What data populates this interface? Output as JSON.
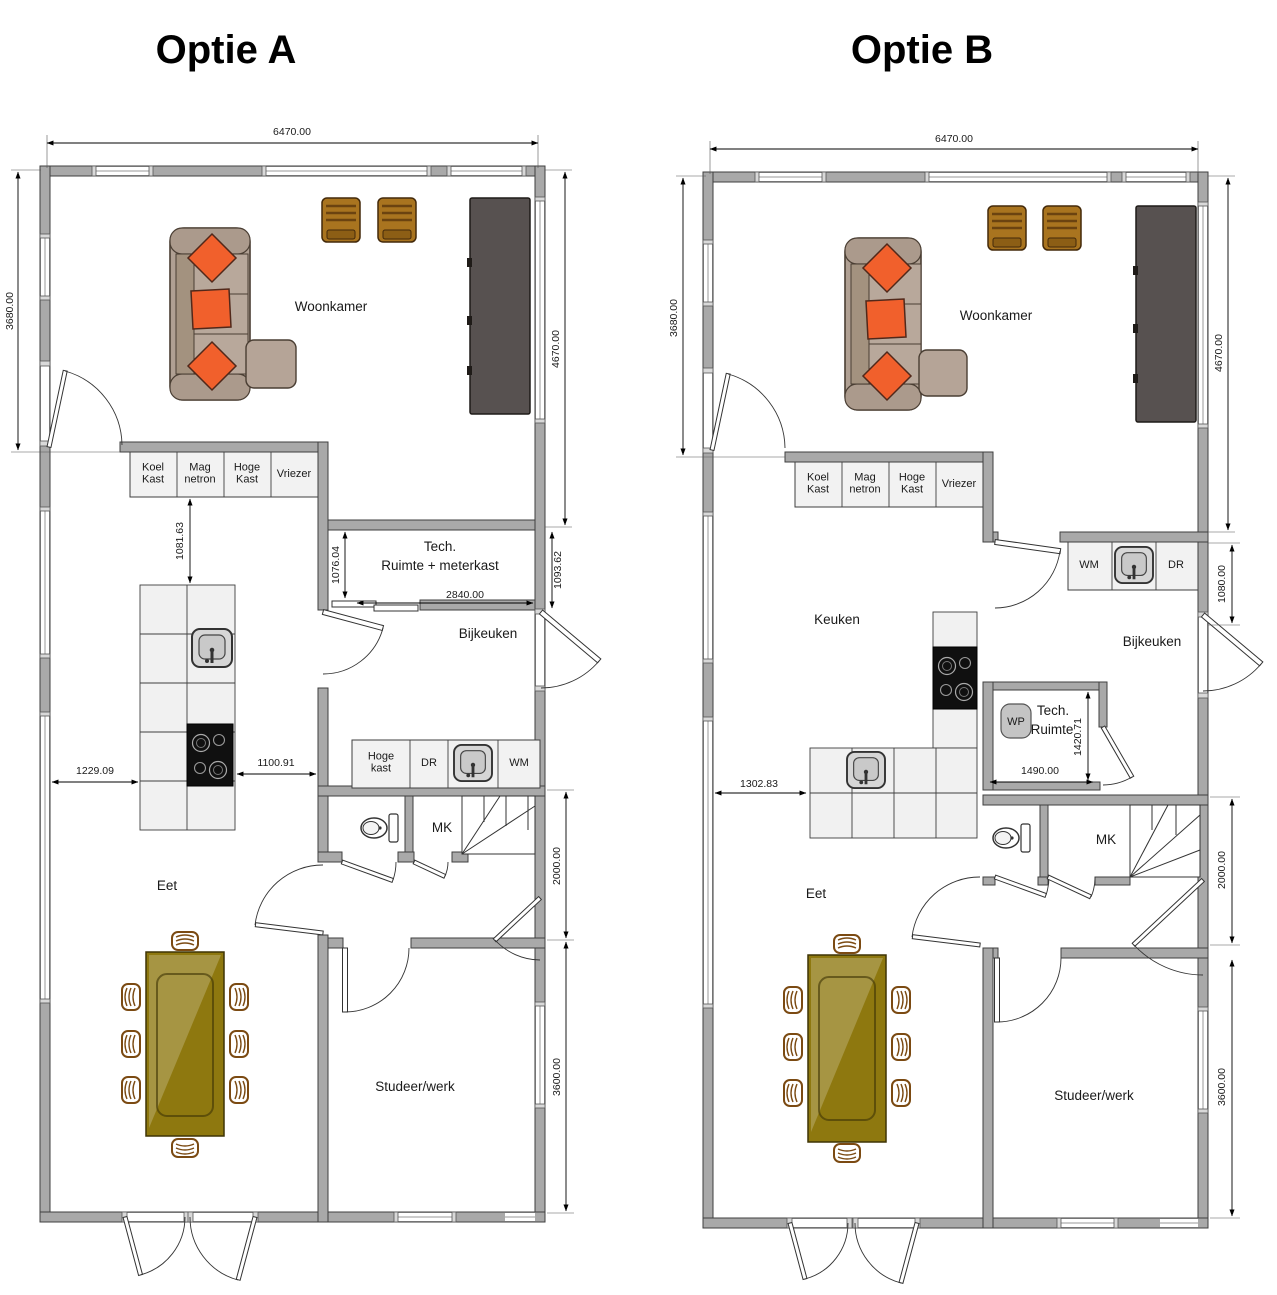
{
  "optionA": {
    "title": "Optie A",
    "dimensions": {
      "top_width": "6470.00",
      "left_height": "3680.00",
      "right_height": "4670.00",
      "island_clearance": "1081.63",
      "tech_height": "1076.04",
      "tech_width": "2840.00",
      "tech_right": "1093.62",
      "island_left": "1229.09",
      "island_right": "1100.91",
      "hall_height": "2000.00",
      "study_height": "3600.00"
    },
    "rooms": {
      "woonkamer": "Woonkamer",
      "tech_line1": "Tech.",
      "tech_line2": "Ruimte + meterkast",
      "bijkeuken": "Bijkeuken",
      "eet": "Eet",
      "studeer": "Studeer/werk",
      "mk": "MK"
    },
    "appliances": {
      "koelkast": "Koel\nKast",
      "magnetron": "Mag\nnetron",
      "hoge_kast": "Hoge\nKast",
      "vriezer": "Vriezer",
      "hoge_kast_laag": "Hoge\nkast",
      "dr": "DR",
      "wm": "WM"
    }
  },
  "optionB": {
    "title": "Optie B",
    "dimensions": {
      "top_width": "6470.00",
      "left_height": "3680.00",
      "right_height": "4670.00",
      "counter_height": "1080.00",
      "tech_height": "1420.71",
      "tech_width": "1490.00",
      "counter_left": "1302.83",
      "hall_height": "2000.00",
      "study_height": "3600.00"
    },
    "rooms": {
      "woonkamer": "Woonkamer",
      "keuken": "Keuken",
      "bijkeuken": "Bijkeuken",
      "tech_line1": "Tech.",
      "tech_line2": "Ruimte",
      "eet": "Eet",
      "studeer": "Studeer/werk",
      "mk": "MK"
    },
    "appliances": {
      "koelkast": "Koel\nKast",
      "magnetron": "Mag\nnetron",
      "hoge_kast": "Hoge\nKast",
      "vriezer": "Vriezer",
      "wm": "WM",
      "dr": "DR",
      "wp": "WP"
    }
  },
  "colors": {
    "wall": "#A9A9A9",
    "accent_pillow": "#F1602C",
    "sofa": "#B0A093",
    "chair_wood": "#A9741F",
    "tv_cabinet": "#575150",
    "table": "#8E780F"
  }
}
